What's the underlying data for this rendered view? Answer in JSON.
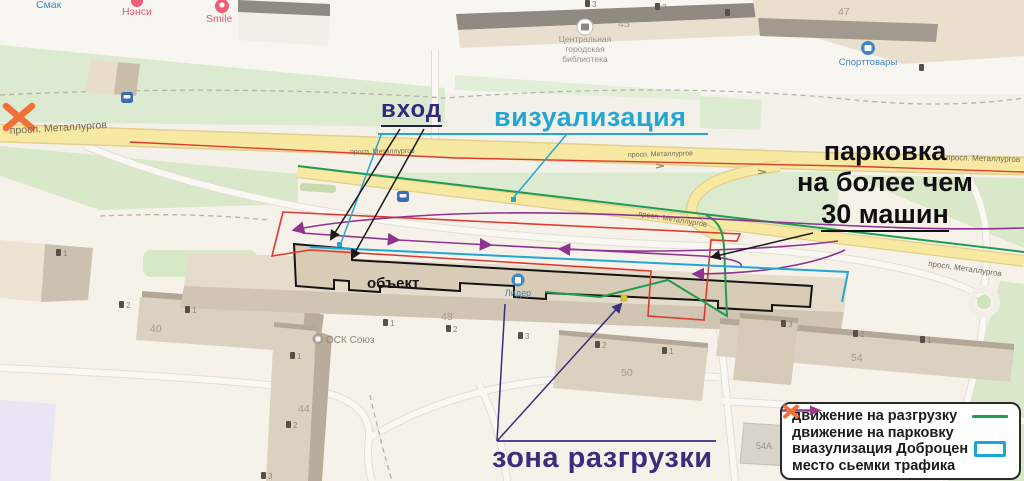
{
  "annotations": {
    "entrance": "вход",
    "visualization": "визуализация",
    "parking1": "парковка",
    "parking2": "на более чем",
    "parking3": "30 машин",
    "unloading": "зона разгрузки"
  },
  "legend": {
    "items": [
      {
        "label": "движение на разгрузку",
        "swatch": "green-line"
      },
      {
        "label": "движение на парковку",
        "swatch": "purple-arrow"
      },
      {
        "label": "виазулизация Доброцен",
        "swatch": "blue-rect"
      },
      {
        "label": "место сьемки трафика",
        "swatch": "orange-x"
      }
    ]
  },
  "map": {
    "street_label": "просп. Металлургов",
    "pois": {
      "smak": "Смак",
      "nensi": "Нэнси",
      "smile": "Smile",
      "lib1": "Центральная",
      "lib2": "городская",
      "lib3": "библиотека",
      "sport": "Спорттовары",
      "lider": "Лидер",
      "osk": "ОСК Союз",
      "obj": "объект"
    },
    "numbers": {
      "b45": "45",
      "b47": "47",
      "b40": "40",
      "b44": "44",
      "b48": "48",
      "b50": "50",
      "b54": "54",
      "b54a": "54A"
    },
    "markers": {
      "m0": "1",
      "m1": "2",
      "m2": "1",
      "m3": "1",
      "m4": "2",
      "m5": "3",
      "m6": "1",
      "m7": "2",
      "m8": "3",
      "m9": "2",
      "m10": "1",
      "m11": "3",
      "m12": "2",
      "m13": "1",
      "m14": "3",
      "m15": "2",
      "m16": "1",
      "m17": ""
    }
  },
  "colors": {
    "entrance_label": "#322a7e",
    "visualization_label": "#23a6d4",
    "unloading_label": "#3a2d7d",
    "legend_green": "#1f9b52",
    "legend_purple": "#8e3490",
    "legend_cyan": "#1ba7d8",
    "legend_orange": "#f07135",
    "road_yellow": "#f8e9a2",
    "survey_red": "#e03a2e"
  }
}
